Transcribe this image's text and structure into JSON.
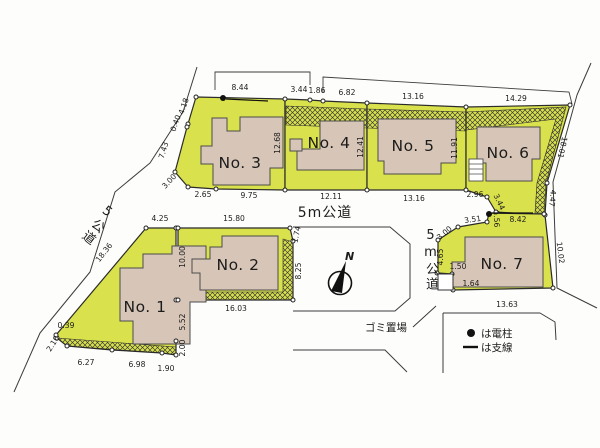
{
  "colors": {
    "lot_fill": "#d9e14c",
    "house_fill": "#d7c6b7",
    "line": "#2a2a2a"
  },
  "roads": {
    "left_diagonal": "5公道",
    "center_horizontal": "5m公道",
    "right_vertical": "5m公道"
  },
  "compass": {
    "north": "N"
  },
  "garbage": {
    "label": "ゴミ置場"
  },
  "legend": {
    "pole_symbol": "●",
    "pole_text": "は電柱",
    "wire_symbol": "—",
    "wire_text": "は支線"
  },
  "lots": {
    "no1": {
      "name": "No. 1",
      "dims": {
        "top": "4.25",
        "left_diag": "18.36",
        "left_a": "0.39",
        "left_b": "2.10",
        "bottom_a": "6.27",
        "bottom_b": "6.98",
        "bottom_c": "1.90",
        "right_a": "10.00",
        "right_b": "5.52",
        "right_c": "2.00"
      }
    },
    "no2": {
      "name": "No. 2",
      "dims": {
        "top": "15.80",
        "top_right": "1.74",
        "right": "8.25",
        "bottom": "16.03"
      }
    },
    "no3": {
      "name": "No. 3",
      "dims": {
        "top": "8.44",
        "left_a": "4.18",
        "left_b": "0.40",
        "left_c": "7.43",
        "left_d": "3.00",
        "bottom_a": "2.65",
        "bottom_b": "9.75",
        "right": "12.68"
      }
    },
    "no4": {
      "name": "No. 4",
      "dims": {
        "top_a": "3.44",
        "top_b": "1.86",
        "top_c": "6.82",
        "bottom": "12.11",
        "right": "12.41"
      }
    },
    "no5": {
      "name": "No. 5",
      "dims": {
        "top": "13.16",
        "bottom": "13.16",
        "right": "11.91"
      }
    },
    "no6": {
      "name": "No. 6",
      "dims": {
        "top": "14.29",
        "right_diag": "18.01",
        "right_lower": "4.47",
        "bottom_a": "2.96",
        "bottom_b": "3.44"
      }
    },
    "no7": {
      "name": "No. 7",
      "dims": {
        "top_a": "3.51",
        "top_b": "1.56",
        "top_c": "8.42",
        "left_a": "3.00",
        "left_b": "4.65",
        "left_c": "1.50",
        "left_d": "1.64",
        "bottom": "13.63",
        "right": "10.02"
      }
    }
  }
}
